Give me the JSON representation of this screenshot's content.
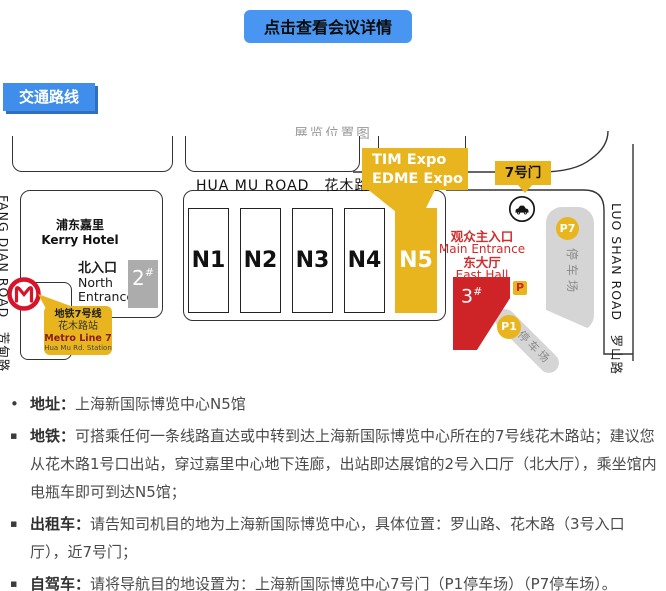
{
  "header": {
    "detail_button_label": "点击查看会议详情"
  },
  "section": {
    "label": "交通路线"
  },
  "map": {
    "title": "展览位置图",
    "roads": {
      "hua_mu": "HUA MU ROAD　花木路",
      "fang_dian": "FANG DIAN ROAD　芳甸路",
      "luo_shan": "LUO SHAN ROAD　罗山路"
    },
    "kerry": {
      "line1": "浦东嘉里",
      "line2": "Kerry Hotel"
    },
    "north_entrance": {
      "line1": "北入口",
      "line2": "North",
      "line3": "Entrance"
    },
    "gate2": {
      "num": "2",
      "hash": "#"
    },
    "halls": [
      {
        "label": "N1"
      },
      {
        "label": "N2"
      },
      {
        "label": "N3"
      },
      {
        "label": "N4"
      },
      {
        "label": "N5"
      }
    ],
    "expo_callout": {
      "line1": "TIM Expo",
      "line2": "EDME Expo"
    },
    "gate7": {
      "label": "7号门"
    },
    "main_entrance": {
      "line1": "观众主入口",
      "line2": "Main Entrance",
      "line3": "东大厅",
      "line4": "East Hall"
    },
    "hall3": {
      "num": "3",
      "hash": "#"
    },
    "parking_badge": "P",
    "p1": {
      "label": "P1",
      "text": "停车场"
    },
    "p7": {
      "label": "P7",
      "text": "停车场"
    },
    "metro": {
      "line1": "地铁7号线",
      "line2": "花木路站",
      "line3": "Metro Line 7",
      "line4": "Hua Mu Rd. Station"
    }
  },
  "info": {
    "items": [
      {
        "bullet": "•",
        "label": "地址：",
        "text": "上海新国际博览中心N5馆"
      },
      {
        "bullet": "▪",
        "label": "地铁：",
        "text": "可搭乘任何一条线路直达或中转到达上海新国际博览中心所在的7号线花木路站；建议您从花木路1号口出站，穿过嘉里中心地下连廊，出站即达展馆的2号入口厅（北大厅），乘坐馆内电瓶车即可到达N5馆；"
      },
      {
        "bullet": "▪",
        "label": "出租车：",
        "text": "请告知司机目的地为上海新国际博览中心，具体位置：罗山路、花木路（3号入口厅），近7号门；"
      },
      {
        "bullet": "▪",
        "label": "自驾车：",
        "text": "请将导航目的地设置为：上海新国际博览中心7号门（P1停车场）（P7停车场）。"
      }
    ]
  },
  "colors": {
    "accent_blue": "#4896F2",
    "gold": "#E9B51F",
    "red": "#CE2428",
    "entrance_red": "#D22B2B",
    "gray_band": "#D5D5D5",
    "gray_box": "#ACACAC"
  }
}
